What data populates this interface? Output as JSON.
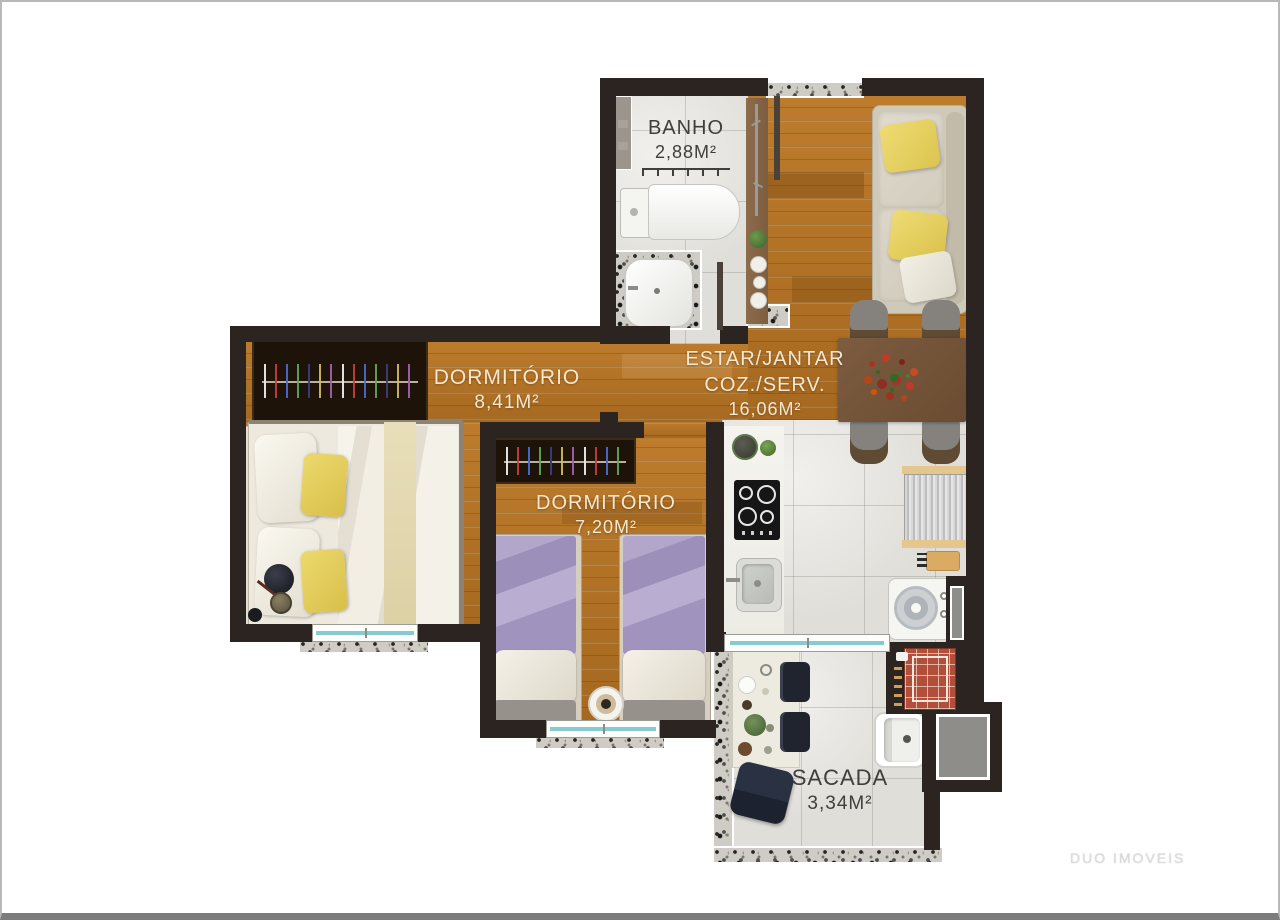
{
  "rooms": {
    "banho": {
      "name": "BANHO",
      "area": "2,88M²"
    },
    "dormitorio_1": {
      "name": "DORMITÓRIO",
      "area": "8,41M²"
    },
    "dormitorio_2": {
      "name": "DORMITÓRIO",
      "area": "7,20M²"
    },
    "estar_jantar": {
      "name_line1": "ESTAR/JANTAR",
      "name_line2": "COZ./SERV.",
      "area": "16,06M²"
    },
    "sacada": {
      "name": "SACADA",
      "area": "3,34M²"
    }
  },
  "watermark": "DUO IMOVEIS",
  "colors": {
    "wall": "#2b2420",
    "wood_floor": "#b07124",
    "tile_floor": "#e0ded8",
    "label_light": "#f3e8d2",
    "label_dark": "#403e3a",
    "window_glass": "#84ccce",
    "brick_grill": "#b14f3a",
    "yellow_pillow": "#e8d160",
    "purple_bedding": "#a89bc1"
  }
}
